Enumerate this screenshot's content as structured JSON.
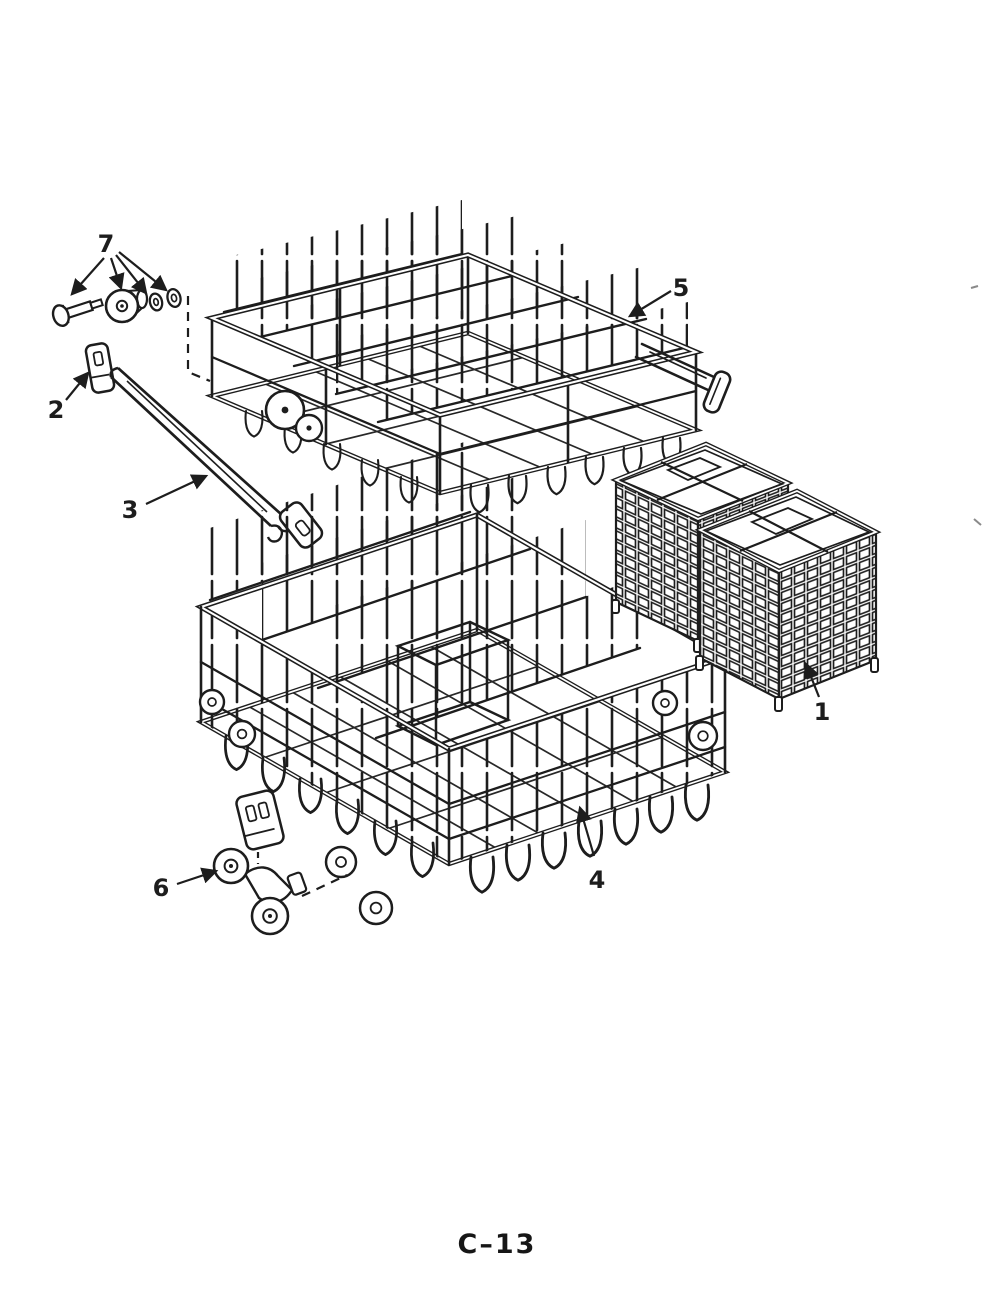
{
  "page": {
    "label": "C–13"
  },
  "palette": {
    "ink": "#1d1d1d",
    "paper": "#ffffff"
  },
  "callouts": [
    {
      "number": "1"
    },
    {
      "number": "2"
    },
    {
      "number": "3"
    },
    {
      "number": "4"
    },
    {
      "number": "5"
    },
    {
      "number": "6"
    },
    {
      "number": "7"
    }
  ]
}
